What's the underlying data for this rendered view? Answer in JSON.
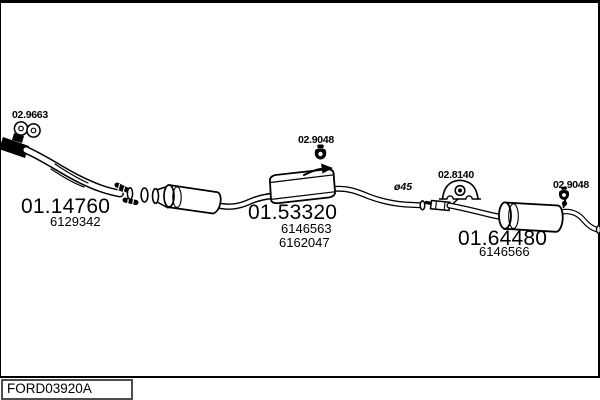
{
  "window": {
    "footer_code": "FORD03920A"
  },
  "parts": {
    "flange_gasket": {
      "ref": "02.9663"
    },
    "front_pipe": {
      "ref": "01.14760",
      "oe": [
        "6129342"
      ]
    },
    "centre_hanger": {
      "ref": "02.9048"
    },
    "centre_silencer": {
      "ref": "01.53320",
      "oe": [
        "6146563",
        "6162047"
      ]
    },
    "connection_diameter": {
      "ref": "ø45"
    },
    "rear_mount": {
      "ref": "02.8140"
    },
    "rear_hanger": {
      "ref": "02.9048"
    },
    "rear_silencer": {
      "ref": "01.64480",
      "oe": [
        "6146566"
      ]
    }
  },
  "icons": {
    "flange_gasket": "gasket-icon",
    "centre_hanger": "rubber-hanger-icon",
    "rear_hanger": "rubber-hanger-icon",
    "rear_mount": "rubber-mount-icon"
  },
  "colors": {
    "ink": "#000000",
    "paper": "#ffffff",
    "footer_border": "#4d4d4d"
  }
}
